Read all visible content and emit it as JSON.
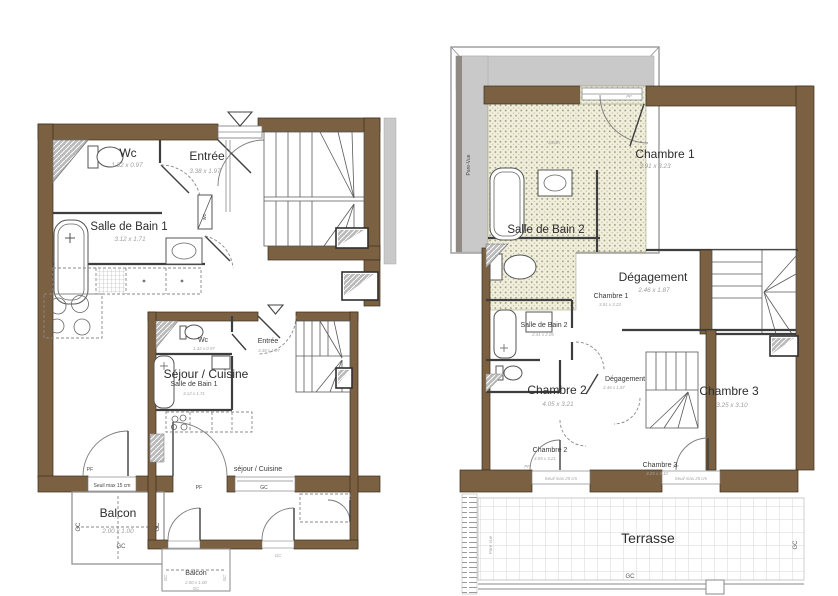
{
  "colors": {
    "wall": "#7b6142",
    "gray_band": "#c9c9c9",
    "stipple_bg": "#f0eedc",
    "stipple_dot": "#9e9e78",
    "dim_text": "#9e9e9e",
    "label_text": "#2d2d2d"
  },
  "annotations": {
    "pf": "PF",
    "gc": "GC",
    "wc_duct": "wc",
    "seuil15": "Seuil max 15 cm",
    "seuil25": "Seuil max 25 cm",
    "pare_vue": "Pare-Vue",
    "pare_vue2": "Pare Vue"
  },
  "floor1": {
    "wc": {
      "name": "Wc",
      "dims": "1.32 x 0.97"
    },
    "entree": {
      "name": "Entrée",
      "dims": "3.38 x 1.97"
    },
    "sdb1": {
      "name": "Salle de Bain 1",
      "dims": "3.12 x 1.71"
    },
    "sejour": {
      "name": "Séjour / Cuisine"
    },
    "balcon": {
      "name": "Balcon",
      "dims": "2.00 x 1.00"
    },
    "inset": {
      "sejour": "séjour / Cuisine"
    }
  },
  "floor2": {
    "jardin": {
      "name": "Jardin"
    },
    "chambre1": {
      "name": "Chambre 1",
      "dims": "3.91 x 3.23"
    },
    "sdb2": {
      "name": "Salle de Bain 2",
      "dims": "2.41 x 2.05"
    },
    "degagement": {
      "name": "Dégagement",
      "dims": "2.46 x 1.87"
    },
    "chambre2": {
      "name": "Chambre 2",
      "dims": "4.05 x 3.21"
    },
    "chambre3": {
      "name": "Chambre 3",
      "dims": "3.25 x 3.10"
    },
    "terrasse": {
      "name": "Terrasse"
    }
  }
}
